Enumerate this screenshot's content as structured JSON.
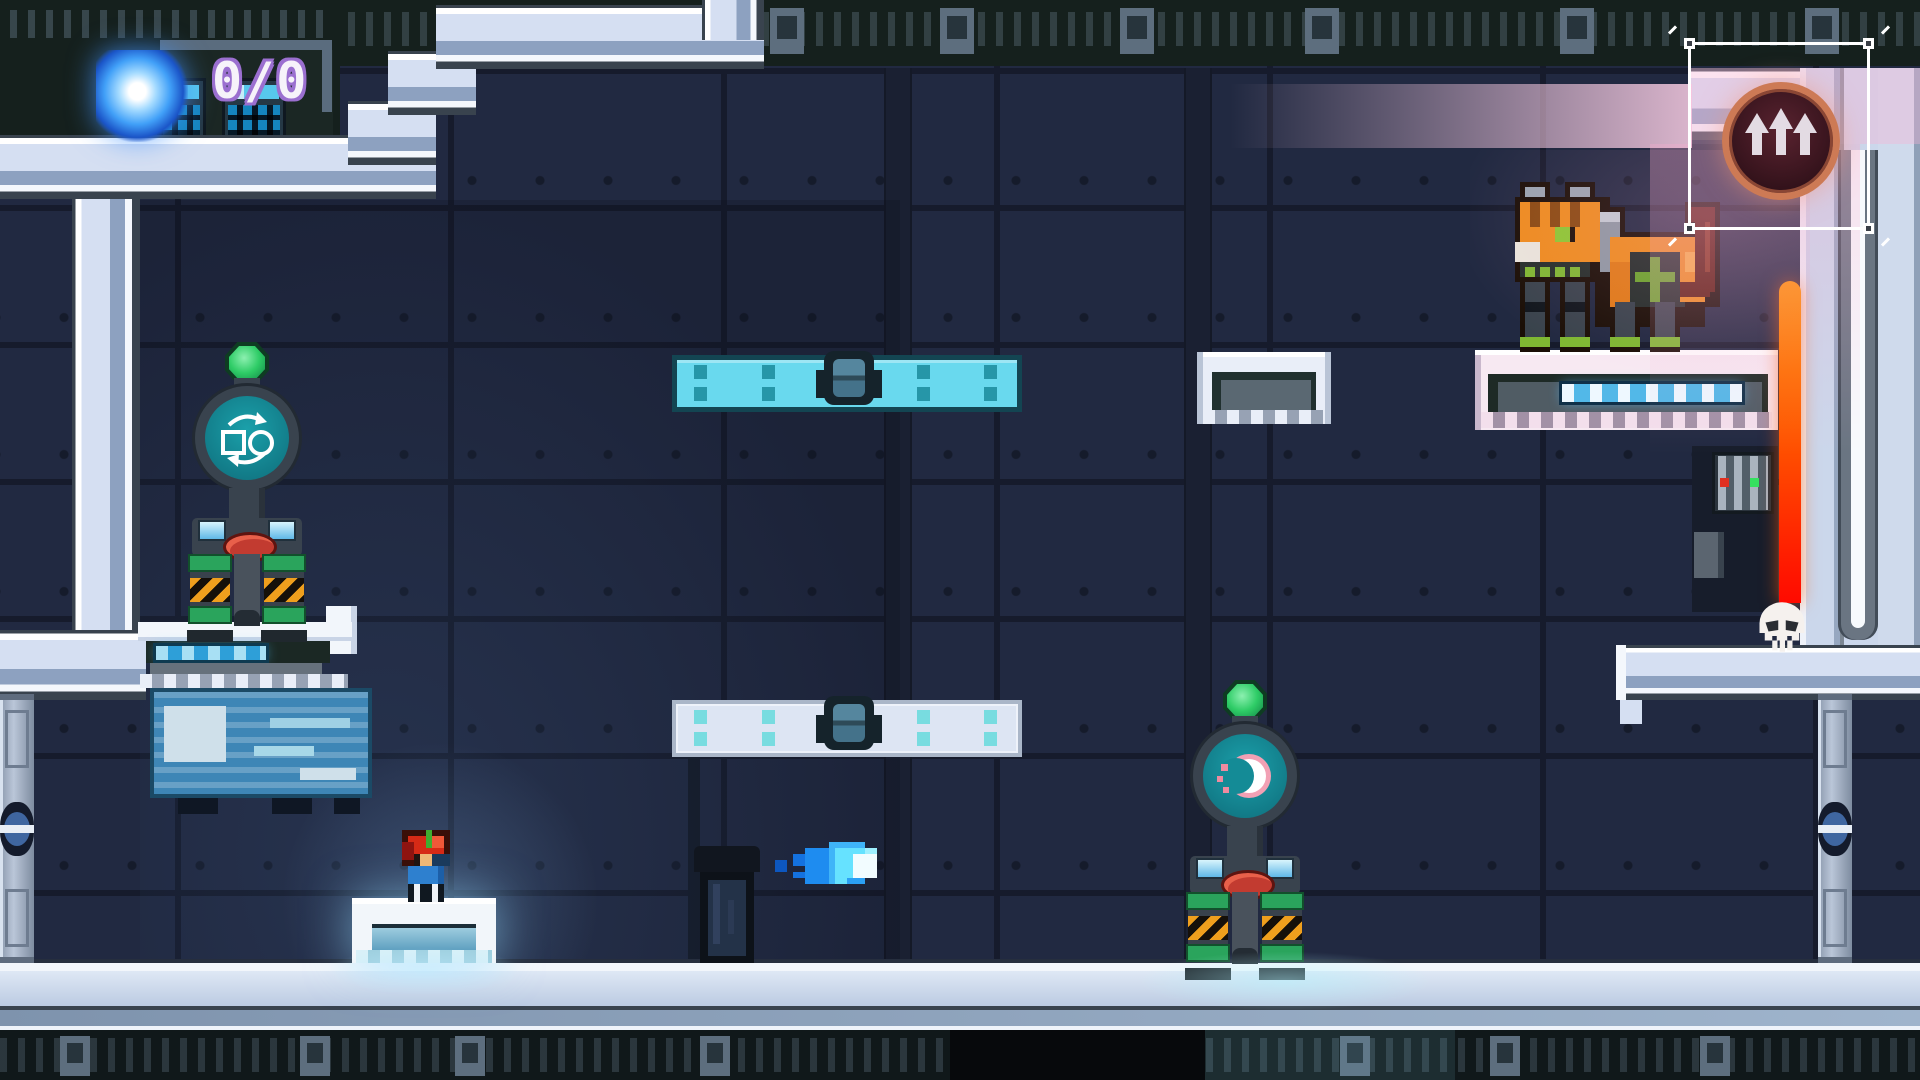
{
  "hud": {
    "orb_counter": "0/0",
    "orb_icon": "energy-orb",
    "counter_outline_color": "#9b6fd0"
  },
  "upgrade_station": {
    "icon": "triple-up-arrow-icon",
    "ring_color": "#cd7a55",
    "selected": true
  },
  "ability_stations": [
    {
      "id": "swap-station",
      "icon": "square-circle-swap-icon",
      "screen_color": "#17858f"
    },
    {
      "id": "dash-station",
      "icon": "crescent-dash-icon",
      "screen_color": "#17858f"
    }
  ],
  "entities": {
    "player": "pixel-hero",
    "enemy": "robot-cat",
    "projectile": "blue-flame",
    "hazard": "laser-beam",
    "hazard_marker": "skull-icon"
  },
  "platforms": {
    "active_color": "#69d9ee",
    "inactive_color": "#dde5f3"
  },
  "colors": {
    "wall": "#212941",
    "frame_light": "#d5dff2",
    "frame_mid": "#8da1c0",
    "beam_pink": "#f8d2e6",
    "laser_top": "#ff9000",
    "laser_bottom": "#ff1500",
    "hazard_orange": "#ef9f1d",
    "gem_green": "#2ecc66",
    "machinery_dark": "#15201d"
  }
}
